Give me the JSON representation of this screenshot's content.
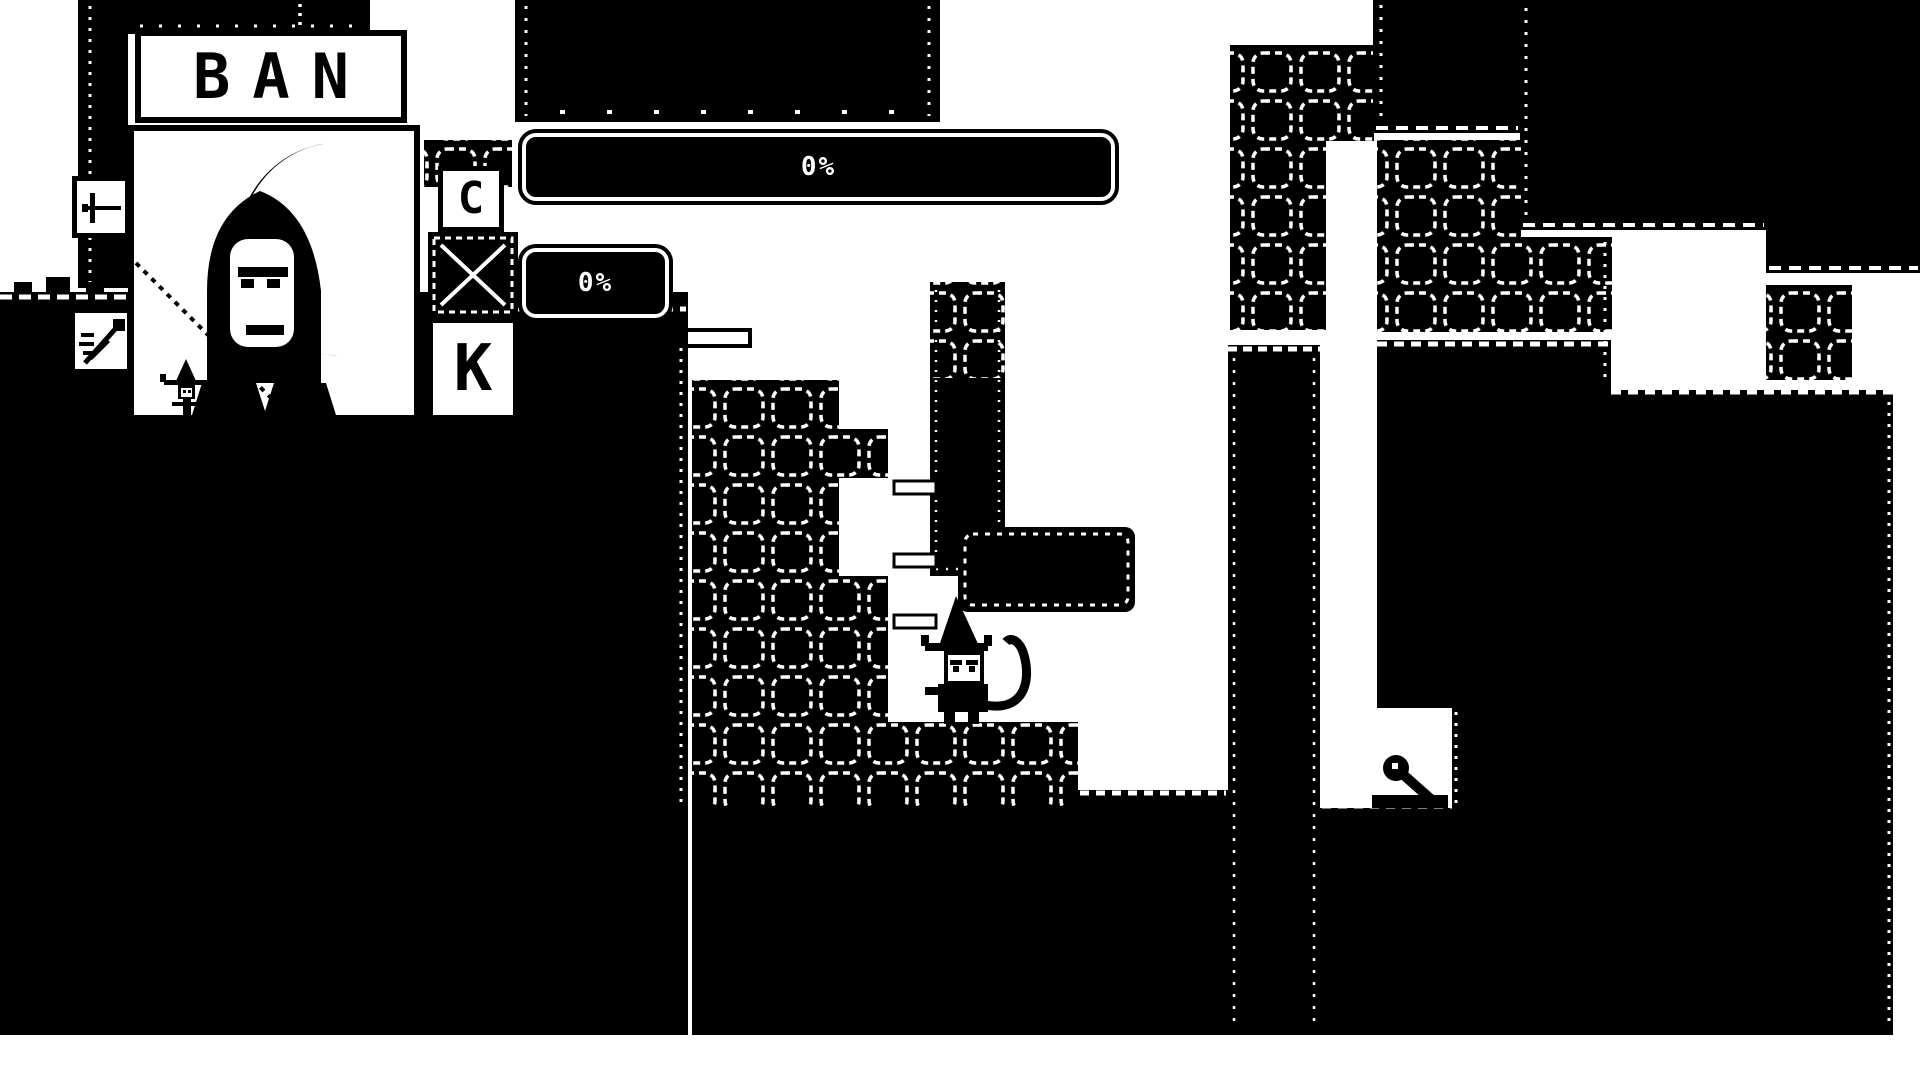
{
  "colors": {
    "ink": "#000000",
    "paper": "#ffffff"
  },
  "bank_sign": {
    "top": "BAN",
    "letter_c": "C",
    "letter_k": "K"
  },
  "hud": {
    "progress_main_value": "0%",
    "progress_small_value": "0%"
  },
  "icons": {
    "left_top": "sword-icon",
    "left_bottom": "pen-icon"
  },
  "sprites": {
    "player": "witch-player",
    "portrait_figure": "hooded-figure",
    "creature": "snail-creature"
  }
}
